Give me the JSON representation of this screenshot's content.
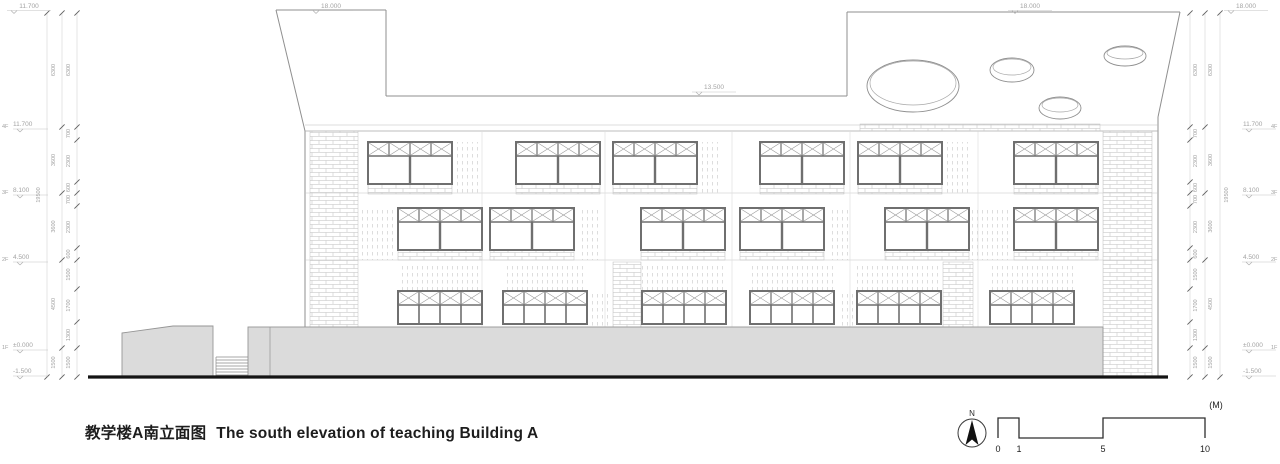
{
  "title": {
    "cn": "教学楼A南立面图",
    "en": "The south elevation of teaching Building A"
  },
  "top_elevations": {
    "far_left": "11.700",
    "left_tower": "18.000",
    "parapet": "13.500",
    "right_tower": "18.000",
    "far_right": "18.000"
  },
  "levels_left": [
    {
      "tag": "4F",
      "value": "11.700"
    },
    {
      "tag": "3F",
      "value": "8.100"
    },
    {
      "tag": "2F",
      "value": "4.500"
    },
    {
      "tag": "1F",
      "value": "±0.000"
    },
    {
      "tag": "",
      "value": "-1.500"
    }
  ],
  "levels_right": [
    {
      "tag": "4F",
      "value": "11.700"
    },
    {
      "tag": "3F",
      "value": "8.100"
    },
    {
      "tag": "2F",
      "value": "4.500"
    },
    {
      "tag": "1F",
      "value": "±0.000"
    },
    {
      "tag": "",
      "value": "-1.500"
    }
  ],
  "dims": {
    "overall": "19500",
    "outer_chain": [
      "6300",
      "3600",
      "3600",
      "4500",
      "1500"
    ],
    "inner_chain": [
      "6300",
      "700",
      "2300",
      "600",
      "700",
      "2300",
      "600",
      "1500",
      "1700",
      "1300",
      "1500"
    ]
  },
  "scalebar": {
    "unit": "(M)",
    "ticks": [
      "0",
      "1",
      "5",
      "10"
    ]
  },
  "north": {
    "label": "N"
  }
}
